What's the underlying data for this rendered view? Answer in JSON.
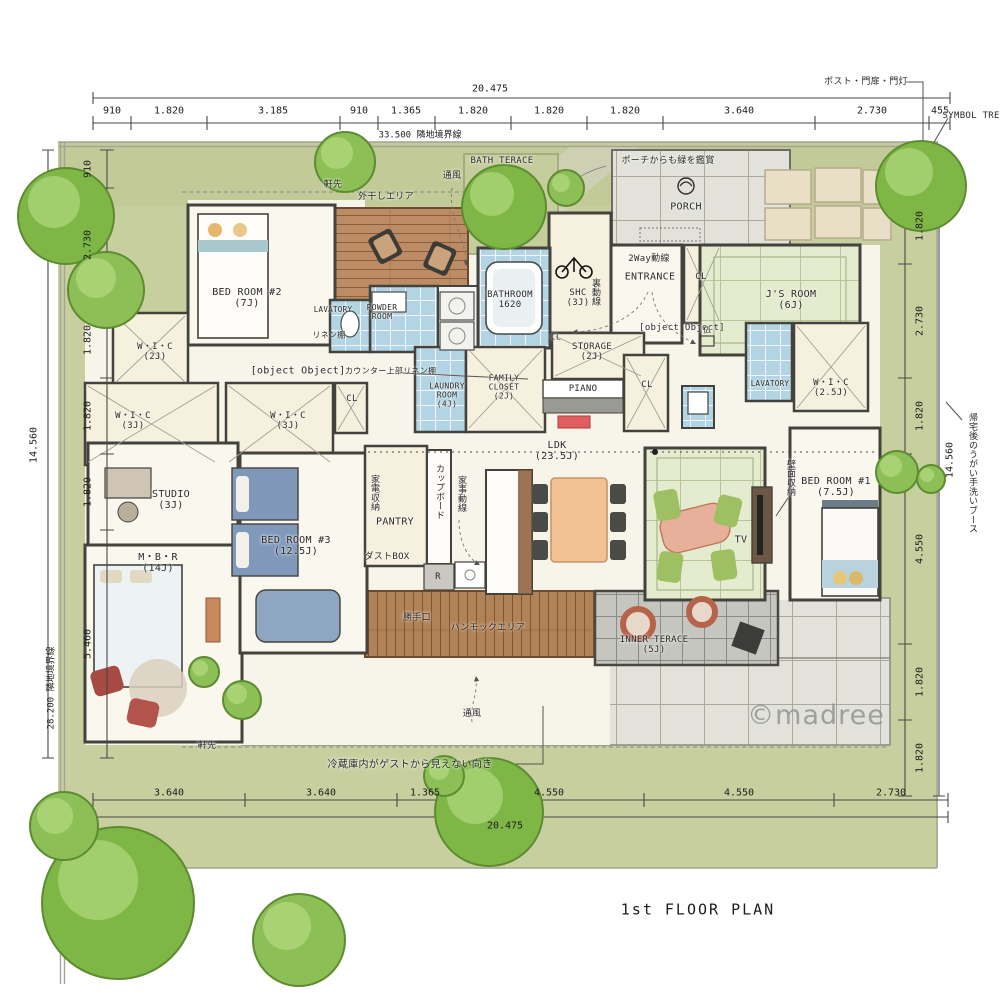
{
  "meta": {
    "plan_title": "1st FLOOR PLAN",
    "watermark": "©madree"
  },
  "boundaries": {
    "top": "33.500 隣地境界線",
    "left": "28.200 隣地境界線"
  },
  "dimensions": {
    "top_total": "20.475",
    "top": [
      "910",
      "1.820",
      "3.185",
      "910",
      "1.365",
      "1.820",
      "1.820",
      "1.820",
      "3.640",
      "2.730",
      "455"
    ],
    "bottom_total": "20.475",
    "bottom": [
      "3.640",
      "3.640",
      "1.365",
      "4.550",
      "4.550",
      "2.730"
    ],
    "left_total": "14.560",
    "left": [
      "910",
      "2.730",
      "1.820",
      "1.820",
      "1.820",
      "5.460"
    ],
    "right_total": "14.560",
    "right": [
      "1.820",
      "2.730",
      "1.820",
      "4.550",
      "1.820",
      "1.820"
    ]
  },
  "rooms": {
    "bedroom2": {
      "name": "BED ROOM #2",
      "size": "(7J)"
    },
    "bedroom3": {
      "name": "BED ROOM #3",
      "size": "(12.5J)"
    },
    "bedroom1": {
      "name": "BED ROOM #1",
      "size": "(7.5J)"
    },
    "mbr": {
      "name": "M・B・R",
      "size": "(14J)"
    },
    "studio": {
      "name": "STUDIO",
      "size": "(3J)"
    },
    "wic2": {
      "name": "W・I・C",
      "size": "(2J)"
    },
    "wic3": {
      "name": "W・I・C",
      "size": "(3J)"
    },
    "wic25": {
      "name": "W・I・C",
      "size": "(2.5J)"
    },
    "jsroom": {
      "name": "J'S ROOM",
      "size": "(6J)"
    },
    "ldk": {
      "name": "LDK",
      "size": "(23.5J)"
    },
    "shc": {
      "name": "SHC",
      "size": "(3J)"
    },
    "storage": {
      "name": "STORAGE",
      "size": "(2J)"
    },
    "family_closet": {
      "name": "FAMILY CLOSET",
      "size": "(2J)"
    },
    "laundry": {
      "name": "LAUNDRY ROOM",
      "size": "(4J)"
    },
    "inner_terrace": {
      "name": "INNER TERACE",
      "size": "(5J)"
    },
    "bathroom": {
      "name": "BATHROOM",
      "size": "1620"
    },
    "powder": {
      "name": "POWDER ROOM"
    },
    "lavatory": {
      "name": "LAVATORY"
    },
    "entrance": {
      "name": "ENTRANCE"
    },
    "porch": {
      "name": "PORCH"
    },
    "pantry": {
      "name": "PANTRY"
    },
    "hall": {
      "name": "HALL"
    },
    "cl": "CL",
    "piano": "PIANO",
    "tv": "TV",
    "fridge": "R",
    "butsudan": "仏"
  },
  "annotations": {
    "post_gate": "ポスト・門扉・門灯",
    "symbol_tree": "SYMBOL TREE",
    "eaves": "軒先",
    "vent": "通風",
    "outdoor_dry": "外干しエリア",
    "bath_terrace": "BATH TERACE",
    "porch_green": "ポーチからも緑を鑑賞",
    "two_way": "2Way動線",
    "back_line": "裏動線",
    "counter_linen": "カウンター上部リネン棚",
    "linen": "リネン棚",
    "appliance_storage": "家電収納",
    "cupboard": "カップボード",
    "housework_line": "家事動線",
    "wall_storage": "壁面収納",
    "dustbox": "ダストBOX",
    "backdoor": "勝手口",
    "hammock": "ハンモックエリア",
    "fridge_note": "冷蔵庫内がゲストから見えない向き",
    "washbooth": "帰宅後のうがい手洗いブース"
  }
}
